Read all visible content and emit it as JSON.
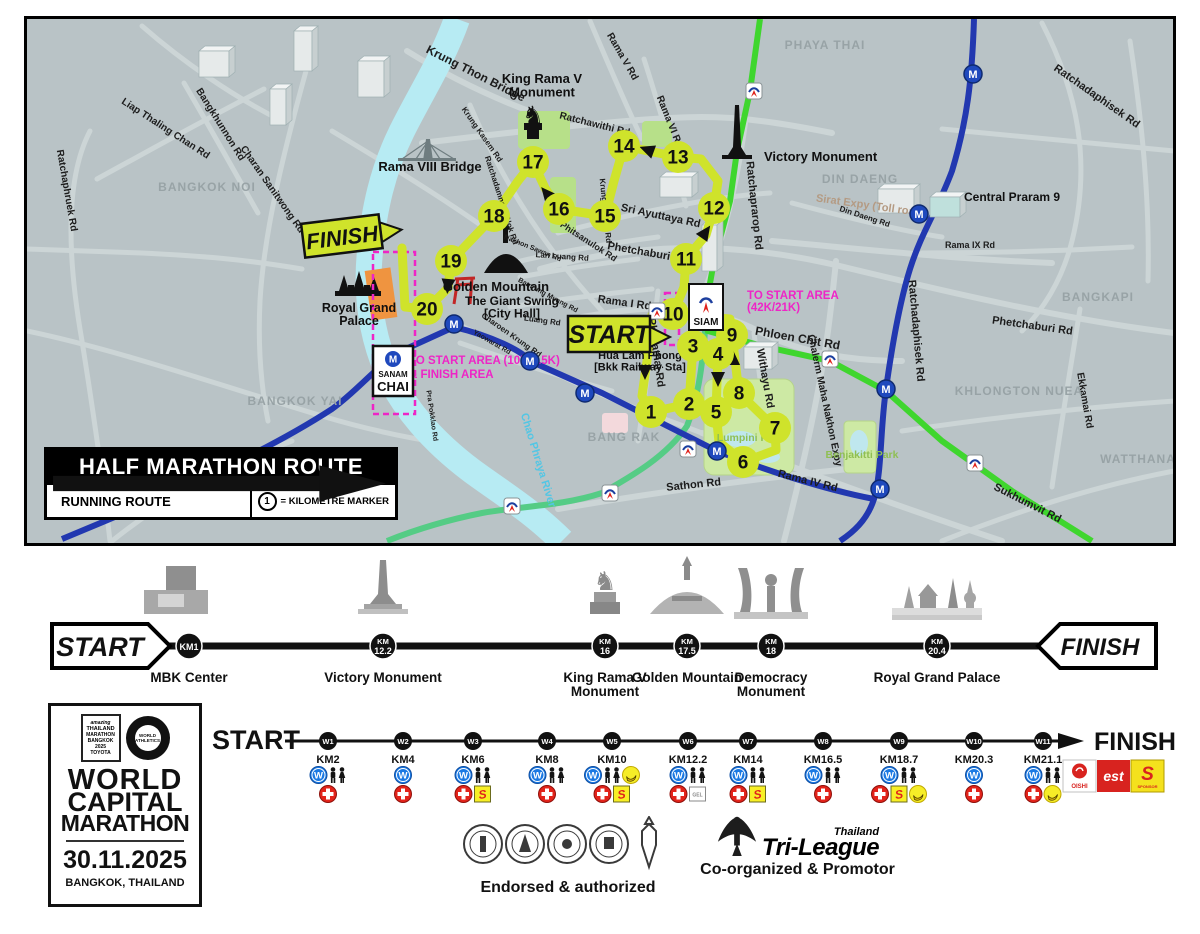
{
  "colors": {
    "route": "#cfe32b",
    "mrt": "#2238b0",
    "bts": "#3fd62e",
    "silom": "#55cc85",
    "river": "#b7ebf3",
    "magenta": "#ee25c6",
    "map_bg": "#b9c3c6"
  },
  "map": {
    "legend": {
      "title": "HALF MARATHON ROUTE",
      "running_route": "RUNNING ROUTE",
      "marker_symbol": "1",
      "marker_text": "= KILOMETRE MARKER"
    },
    "start_label": "START",
    "finish_label": "FINISH",
    "km_markers": [
      {
        "n": "1",
        "x": 649,
        "y": 411
      },
      {
        "n": "2",
        "x": 687,
        "y": 403
      },
      {
        "n": "3",
        "x": 691,
        "y": 345
      },
      {
        "n": "4",
        "x": 716,
        "y": 353
      },
      {
        "n": "5",
        "x": 714,
        "y": 411
      },
      {
        "n": "6",
        "x": 741,
        "y": 461
      },
      {
        "n": "7",
        "x": 773,
        "y": 427
      },
      {
        "n": "8",
        "x": 737,
        "y": 392
      },
      {
        "n": "9",
        "x": 730,
        "y": 334
      },
      {
        "n": "10",
        "x": 671,
        "y": 313
      },
      {
        "n": "11",
        "x": 684,
        "y": 258
      },
      {
        "n": "12",
        "x": 712,
        "y": 207
      },
      {
        "n": "13",
        "x": 676,
        "y": 156
      },
      {
        "n": "14",
        "x": 622,
        "y": 145
      },
      {
        "n": "15",
        "x": 603,
        "y": 215
      },
      {
        "n": "16",
        "x": 557,
        "y": 208
      },
      {
        "n": "17",
        "x": 531,
        "y": 161
      },
      {
        "n": "18",
        "x": 492,
        "y": 215
      },
      {
        "n": "19",
        "x": 449,
        "y": 260
      },
      {
        "n": "20",
        "x": 425,
        "y": 308
      }
    ],
    "route_arrows": [
      {
        "x": 643,
        "y": 370,
        "r": 180
      },
      {
        "x": 691,
        "y": 330,
        "r": 0
      },
      {
        "x": 716,
        "y": 377,
        "r": 180
      },
      {
        "x": 731,
        "y": 358,
        "r": 0
      },
      {
        "x": 703,
        "y": 232,
        "r": 35
      },
      {
        "x": 646,
        "y": 149,
        "r": -70
      },
      {
        "x": 545,
        "y": 193,
        "r": -40
      },
      {
        "x": 446,
        "y": 284,
        "r": 185
      }
    ],
    "mrt_stations": [
      [
        971,
        73
      ],
      [
        917,
        213
      ],
      [
        884,
        388
      ],
      [
        878,
        488
      ],
      [
        452,
        323
      ],
      [
        528,
        360
      ],
      [
        583,
        392
      ],
      [
        715,
        450
      ]
    ],
    "bts_stops": [
      [
        752,
        90
      ],
      [
        655,
        310
      ],
      [
        828,
        358
      ],
      [
        686,
        448
      ],
      [
        608,
        492
      ],
      [
        510,
        505
      ],
      [
        973,
        462
      ]
    ],
    "siam_station": {
      "label": "SIAM"
    },
    "sanam_chai_station": {
      "lines": [
        "SANAM",
        "CHAI"
      ]
    },
    "roads": [
      {
        "t": "Ratchaphruek Rd",
        "x": 62,
        "y": 190,
        "r": 80,
        "s": 10
      },
      {
        "t": "Liap Thaling Chan Rd",
        "x": 162,
        "y": 130,
        "r": 33,
        "s": 10
      },
      {
        "t": "Bangkhunnon Rd",
        "x": 216,
        "y": 125,
        "r": 58,
        "s": 10
      },
      {
        "t": "Charan Sanitwong Rd",
        "x": 268,
        "y": 190,
        "r": 55,
        "s": 10
      },
      {
        "t": "Krung Thon Bridge",
        "x": 472,
        "y": 76,
        "r": 27,
        "s": 12
      },
      {
        "t": "Rama V Rd",
        "x": 618,
        "y": 57,
        "r": 60,
        "s": 10
      },
      {
        "t": "Rama VI Rd",
        "x": 665,
        "y": 122,
        "r": 68,
        "s": 10
      },
      {
        "t": "Ratchawithi Rd",
        "x": 592,
        "y": 126,
        "r": 14,
        "s": 10
      },
      {
        "t": "Sri Ayuttaya Rd",
        "x": 658,
        "y": 218,
        "r": 12,
        "s": 11
      },
      {
        "t": "Phetchaburi Rd",
        "x": 645,
        "y": 255,
        "r": 10,
        "s": 11
      },
      {
        "t": "Phitsanulok Rd",
        "x": 585,
        "y": 243,
        "r": 33,
        "s": 9
      },
      {
        "t": "Ratchaprarop Rd",
        "x": 749,
        "y": 205,
        "r": 84,
        "s": 11
      },
      {
        "t": "Ratchadamnoen Nok Rd",
        "x": 497,
        "y": 200,
        "r": 72,
        "s": 8
      },
      {
        "t": "Krung Kasem Rd",
        "x": 478,
        "y": 135,
        "r": 55,
        "s": 8
      },
      {
        "t": "Krung Kasem Rd",
        "x": 601,
        "y": 210,
        "r": 84,
        "s": 8
      },
      {
        "t": "Nakhon Sawan Rd",
        "x": 530,
        "y": 249,
        "r": 22,
        "s": 7
      },
      {
        "t": "Lan Luang Rd",
        "x": 560,
        "y": 258,
        "r": 4,
        "s": 8
      },
      {
        "t": "Bamrung Muang Rd",
        "x": 545,
        "y": 296,
        "r": 28,
        "s": 7
      },
      {
        "t": "Luang Rd",
        "x": 540,
        "y": 322,
        "r": 8,
        "s": 8
      },
      {
        "t": "Charoen Krung Rd",
        "x": 508,
        "y": 336,
        "r": 35,
        "s": 8
      },
      {
        "t": "Yaowarat Rd",
        "x": 489,
        "y": 343,
        "r": 30,
        "s": 7
      },
      {
        "t": "Pra Pokklao Rd",
        "x": 428,
        "y": 415,
        "r": 82,
        "s": 7
      },
      {
        "t": "Rama I Rd",
        "x": 622,
        "y": 305,
        "r": 8,
        "s": 11
      },
      {
        "t": "Phayathai Rd",
        "x": 651,
        "y": 352,
        "r": 82,
        "s": 11
      },
      {
        "t": "Phloen Chit Rd",
        "x": 795,
        "y": 341,
        "r": 10,
        "s": 12
      },
      {
        "t": "Withayu Rd",
        "x": 760,
        "y": 378,
        "r": 80,
        "s": 11
      },
      {
        "t": "Chalerm Maha Nakhon Expy",
        "x": 820,
        "y": 400,
        "r": 78,
        "s": 10
      },
      {
        "t": "Sathon Rd",
        "x": 692,
        "y": 487,
        "r": -6,
        "s": 11
      },
      {
        "t": "Rama IV Rd",
        "x": 805,
        "y": 483,
        "r": 14,
        "s": 11
      },
      {
        "t": "Sirat Expy (Toll road)",
        "x": 868,
        "y": 208,
        "r": 8,
        "s": 11,
        "c": "#b49a82"
      },
      {
        "t": "Ratchadaphisek Rd",
        "x": 1093,
        "y": 98,
        "r": 35,
        "s": 11
      },
      {
        "t": "Ratchadaphisek Rd",
        "x": 911,
        "y": 330,
        "r": 85,
        "s": 11
      },
      {
        "t": "Din Daeng Rd",
        "x": 862,
        "y": 218,
        "r": 18,
        "s": 8
      },
      {
        "t": "Rama IX Rd",
        "x": 968,
        "y": 247,
        "r": 0,
        "s": 9
      },
      {
        "t": "Ekkamai Rd",
        "x": 1080,
        "y": 400,
        "r": 80,
        "s": 10
      },
      {
        "t": "Sukhumvit Rd",
        "x": 1024,
        "y": 505,
        "r": 27,
        "s": 11
      },
      {
        "t": "Phetchaburi Rd",
        "x": 1030,
        "y": 328,
        "r": 8,
        "s": 11
      }
    ],
    "areas": [
      {
        "t": "BANGKOK NOI",
        "x": 205,
        "y": 190
      },
      {
        "t": "BANGKOK YAI",
        "x": 293,
        "y": 404
      },
      {
        "t": "BANG RAK",
        "x": 622,
        "y": 440
      },
      {
        "t": "PHAYA THAI",
        "x": 823,
        "y": 48
      },
      {
        "t": "DIN DAENG",
        "x": 858,
        "y": 182
      },
      {
        "t": "BANGKAPI",
        "x": 1096,
        "y": 300
      },
      {
        "t": "KHLONGTON NUEA",
        "x": 1017,
        "y": 394
      },
      {
        "t": "WATTHANA",
        "x": 1136,
        "y": 462
      }
    ],
    "parks": [
      {
        "t": "Lumpini Park",
        "x": 748,
        "y": 440
      },
      {
        "t": "Benjakitti Park",
        "x": 860,
        "y": 457
      }
    ],
    "river_label": {
      "t": "Chao Phraya River",
      "x": 533,
      "y": 460,
      "r": 73
    },
    "landmark_labels": [
      {
        "lines": [
          "King Rama V",
          "Monument"
        ],
        "x": 540,
        "y": 82,
        "s": 13
      },
      {
        "lines": [
          "Victory Monument"
        ],
        "x": 762,
        "y": 160,
        "s": 13,
        "a": "start"
      },
      {
        "lines": [
          "Golden Mountain"
        ],
        "x": 494,
        "y": 290,
        "s": 13
      },
      {
        "lines": [
          "The Giant Swing",
          "[City Hall]"
        ],
        "x": 510,
        "y": 304,
        "s": 12
      },
      {
        "lines": [
          "Rama VIII Bridge"
        ],
        "x": 428,
        "y": 170,
        "s": 13
      },
      {
        "lines": [
          "Royal Grand",
          "Palace"
        ],
        "x": 357,
        "y": 311,
        "s": 12.5
      },
      {
        "lines": [
          "Central Praram 9"
        ],
        "x": 962,
        "y": 200,
        "s": 12,
        "a": "start"
      },
      {
        "lines": [
          "Hua Lam Phong",
          "[Bkk Railway Sta]"
        ],
        "x": 638,
        "y": 358,
        "s": 11
      }
    ],
    "notes": [
      {
        "t": "TO START AREA",
        "x": 745,
        "y": 298
      },
      {
        "t": "(42K/21K)",
        "x": 745,
        "y": 310
      },
      {
        "t": "TO START AREA (10K/4.5K)",
        "x": 407,
        "y": 363
      },
      {
        "t": "& FINISH AREA",
        "x": 407,
        "y": 377
      }
    ]
  },
  "landmark_timeline": {
    "start": "START",
    "finish": "FINISH",
    "stops": [
      {
        "icon": "mbk",
        "km": [
          "KM1"
        ],
        "name": [
          "MBK Center"
        ],
        "x": 189
      },
      {
        "icon": "victory",
        "km": [
          "KM",
          "12.2"
        ],
        "name": [
          "Victory Monument"
        ],
        "x": 383
      },
      {
        "icon": "rama5",
        "km": [
          "KM",
          "16"
        ],
        "name": [
          "King Rama V",
          "Monument"
        ],
        "x": 605
      },
      {
        "icon": "golden",
        "km": [
          "KM",
          "17.5"
        ],
        "name": [
          "Golden Mountain"
        ],
        "x": 687
      },
      {
        "icon": "democracy",
        "km": [
          "KM",
          "18"
        ],
        "name": [
          "Democracy",
          "Monument"
        ],
        "x": 771
      },
      {
        "icon": "palace",
        "km": [
          "KM",
          "20.4"
        ],
        "name": [
          "Royal Grand Palace"
        ],
        "x": 937
      }
    ]
  },
  "water_stations": {
    "start": "START",
    "finish": "FINISH",
    "stations": [
      {
        "id": "W1",
        "km": "KM2",
        "x": 328,
        "row1": [
          "water",
          "toilet"
        ],
        "row2": [
          "aid"
        ]
      },
      {
        "id": "W2",
        "km": "KM4",
        "x": 403,
        "row1": [
          "water"
        ],
        "row2": [
          "aid"
        ]
      },
      {
        "id": "W3",
        "km": "KM6",
        "x": 473,
        "row1": [
          "water",
          "toilet"
        ],
        "row2": [
          "aid",
          "sponge"
        ]
      },
      {
        "id": "W4",
        "km": "KM8",
        "x": 547,
        "row1": [
          "water",
          "toilet"
        ],
        "row2": [
          "aid"
        ]
      },
      {
        "id": "W5",
        "km": "KM10",
        "x": 612,
        "row1": [
          "water",
          "toilet",
          "banana"
        ],
        "row2": [
          "aid",
          "sponge"
        ]
      },
      {
        "id": "W6",
        "km": "KM12.2",
        "x": 688,
        "row1": [
          "water",
          "toilet"
        ],
        "row2": [
          "aid",
          "gel"
        ]
      },
      {
        "id": "W7",
        "km": "KM14",
        "x": 748,
        "row1": [
          "water",
          "toilet"
        ],
        "row2": [
          "aid",
          "sponge"
        ]
      },
      {
        "id": "W8",
        "km": "KM16.5",
        "x": 823,
        "row1": [
          "water",
          "toilet"
        ],
        "row2": [
          "aid"
        ]
      },
      {
        "id": "W9",
        "km": "KM18.7",
        "x": 899,
        "row1": [
          "water",
          "toilet"
        ],
        "row2": [
          "aid",
          "sponge",
          "banana"
        ]
      },
      {
        "id": "W10",
        "km": "KM20.3",
        "x": 974,
        "row1": [
          "water"
        ],
        "row2": [
          "aid"
        ]
      },
      {
        "id": "W11",
        "km": "KM21.1",
        "x": 1043,
        "row1": [
          "water",
          "toilet"
        ],
        "row2": [
          "aid",
          "banana"
        ]
      }
    ],
    "sponsors": [
      {
        "id": "oishi",
        "label": "OISHI"
      },
      {
        "id": "est",
        "label": "est"
      },
      {
        "id": "sponsor",
        "label": "S",
        "sub": "SPONSOR"
      }
    ]
  },
  "event": {
    "badge_thai": [
      "amazing",
      "THAILAND",
      "MARATHON",
      "BANGKOK",
      "2025",
      "TOYOTA"
    ],
    "badge_wa": [
      "WORLD",
      "ATHLETICS"
    ],
    "title_lines": [
      "WORLD",
      "CAPITAL",
      "MARATHON"
    ],
    "date": "30.11.2025",
    "location": "BANGKOK, THAILAND"
  },
  "footer": {
    "endorsed_label": "Endorsed & authorized",
    "coorg_label": "Co-organized & Promotor",
    "tri_league": {
      "top": "Thailand",
      "main": "Tri-League"
    }
  }
}
